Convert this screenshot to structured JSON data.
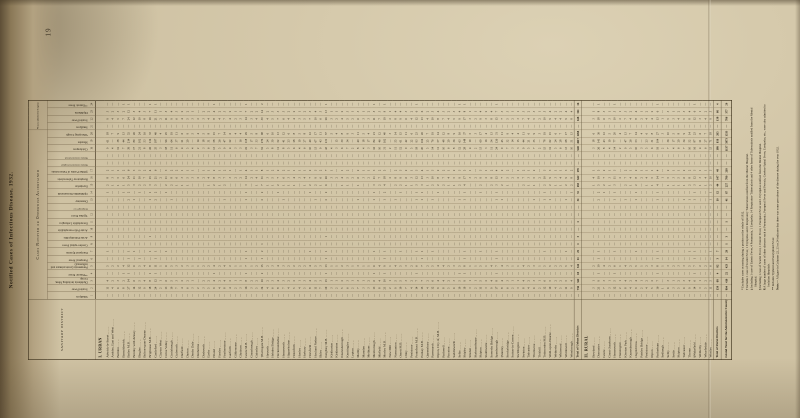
{
  "page": {
    "number": "19",
    "title": "Notified Cases of Infectious Disease, 1932."
  },
  "table": {
    "corner_header": "SANITARY DISTRICT",
    "group_notified": "Cases Notified or Otherwise Ascertained",
    "group_admitted": "¶Cases admitted to Hospital.",
    "columns": [
      {
        "num": "1",
        "label": "Smallpox",
        "thin": false
      },
      {
        "num": "2",
        "label": "Scarlet Fever",
        "thin": false
      },
      {
        "num": "3",
        "label": "Diphtheria including Mem. Croup",
        "thin": false
      },
      {
        "num": "4",
        "label": "**Enteric Fever",
        "thin": false
      },
      {
        "num": "5",
        "label": "Pneumonia (acute primary and influenzal)",
        "thin": false
      },
      {
        "num": "6",
        "label": "Puerperal Fever",
        "thin": false
      },
      {
        "num": "7",
        "label": "Puerperal Pyrexia",
        "thin": false
      },
      {
        "num": "8",
        "label": "Cerebro-spinal Fever",
        "thin": false
      },
      {
        "num": "9",
        "label": "Acute Poliomyelitis",
        "thin": false
      },
      {
        "num": "10",
        "label": "Acute Polio-encephalitis",
        "thin": false
      },
      {
        "num": "11",
        "label": "Encephalitis Lethargica",
        "thin": false
      },
      {
        "num": "12",
        "label": "Typhus Fever",
        "thin": false
      },
      {
        "num": "",
        "label": "Relapsing Fever",
        "thin": true
      },
      {
        "num": "13",
        "label": "Dysentery",
        "thin": false
      },
      {
        "num": "14",
        "label": "Ophthalmia Neonatorum",
        "thin": false
      },
      {
        "num": "15",
        "label": "Erysipelas",
        "thin": false
      },
      {
        "num": "16",
        "label": "Respiratory Tuberculosis",
        "thin": false
      },
      {
        "num": "17",
        "label": "§Other Forms of Tuberculosis",
        "thin": false
      },
      {
        "num": "",
        "label": "Malaria contracted in England",
        "thin": true
      },
      {
        "num": "",
        "label": "Malaria contracted abroad",
        "thin": true
      },
      {
        "num": "18",
        "label": "Chickenpox",
        "thin": false
      },
      {
        "num": "19",
        "label": "Measles",
        "thin": false
      },
      {
        "num": "20",
        "label": "Whooping Cough",
        "thin": false
      },
      {
        "num": "21",
        "label": "Smallpox",
        "thin": false
      },
      {
        "num": "22",
        "label": "Scarlet Fever",
        "thin": false
      },
      {
        "num": "23",
        "label": "Diphtheria",
        "thin": false
      },
      {
        "num": "24",
        "label": "**Enteric Fever",
        "thin": false
      }
    ],
    "sections": [
      {
        "header": "I. URBAN",
        "rows": [
          {
            "name": "Adwick-le-Street",
            "v": "— 11 4 — 5 — 1 — — — — — — — 1 2 8 2 — — 9 61 18 — 9 3 —"
          },
          {
            "name": "Ardsley, East and West",
            "v": "— 4 2 — 2 — — — — — — — — — — 1 3 1 — — 4 — 7 — 4 2 —"
          },
          {
            "name": "Baildon",
            "v": "— 6 3 — 2 — — — — — — — — — — 1 5 1 — — 12 38 9 — 5 3 —"
          },
          {
            "name": "Barnoldswick",
            "v": "— 8 2 1 4 — — — — — — — — — 1 1 6 2 — — 7 44 13 — 7 2 1"
          },
          {
            "name": "Batley M.B.",
            "v": "— 27 14 1 12 1 1 — — — — — — 2 2 5 24 6 — — 39 214 52 — 24 12 1"
          },
          {
            "name": "Bentley with Arksey",
            "v": "— 14 6 — 6 — 1 — — — — — — 1 — 3 11 3 — — 17 89 26 — 12 5 —"
          },
          {
            "name": "Bingley",
            "v": "— 12 5 — 5 1 — — — — — — — — 1 2 10 3 — — 21 102 24 — 10 4 —"
          },
          {
            "name": "Bolton-upon-Dearne",
            "v": "— 9 4 — 4 — — — — — — — — — — 2 7 2 — — 8 53 16 — 8 3 —"
          },
          {
            "name": "Brighouse M.B.",
            "v": "— 18 8 1 8 — 1 — 1 — — — — 1 1 3 15 4 — — 26 134 33 — 16 7 1"
          },
          {
            "name": "Castleford",
            "v": "— 24 12 1 11 1 1 — — — — — — 2 2 5 21 6 — — 35 187 46 — 21 11 1"
          },
          {
            "name": "Clayton West",
            "v": "— 2 1 — 1 — — — — — — — — — — — 2 — — — 3 — 4 — 2 1 —"
          },
          {
            "name": "Colne Valley",
            "v": "— 13 6 — 6 — 1 — — — — — — — 1 2 11 3 — — 18 96 25 — 11 5 —"
          },
          {
            "name": "Conisbrough",
            "v": "— 10 5 — 5 — — — — — — — — 1 — 2 8 2 — — 11 64 19 — 9 4 —"
          },
          {
            "name": "Cudworth",
            "v": "— 7 3 — 3 — — — — — — — — — — 1 6 2 — — 6 37 11 — 6 3 —"
          },
          {
            "name": "Darfield",
            "v": "— 4 2 — 2 — — — — — — — — — — 1 3 1 — — 4 21 6 — 4 2 —"
          },
          {
            "name": "Darton",
            "v": "— 6 2 — 3 — — — — — — — — — — 1 5 1 — — 5 29 9 — 5 2 —"
          },
          {
            "name": "Denby Dale",
            "v": "— 3 1 — 1 — — — — — — — — — — — 3 1 — — 4 — 5 — 3 1 —"
          },
          {
            "name": "Denholme",
            "v": "— 2 — — 1 — — — — — — — — — — — 2 — — — 2 14 4 — 2 — —"
          },
          {
            "name": "Dodworth",
            "v": "— 3 2 — 2 — — — — — — — — — — — 2 1 — — 3 18 5 — 3 2 —"
          },
          {
            "name": "Earby",
            "v": "— 5 2 — 2 — — — — — — — — — — 1 4 1 — — 6 31 8 — 4 2 —"
          },
          {
            "name": "Elland",
            "v": "— 9 4 1 4 — — — — — — — — — — 2 8 2 — — 13 58 15 — 8 4 1"
          },
          {
            "name": "Farsley",
            "v": "— 4 2 — 2 — — — — — — — — — — 1 3 1 — — 5 26 7 — 4 2 —"
          },
          {
            "name": "Featherstone",
            "v": "— 8 4 — 4 — — — — — — — — 1 — 2 7 2 — — 9 47 14 — 7 3 —"
          },
          {
            "name": "Garforth",
            "v": "— 4 2 — 2 — — — — — — — — — — — 3 1 — — 4 22 6 — 4 2 —"
          },
          {
            "name": "Gildersome",
            "v": "— 2 1 — 1 — — — — — — — — — — — 2 — — — 3 — 4 — 2 1 —"
          },
          {
            "name": "Glusburn",
            "v": "— 3 1 — 1 — — — — — — — — — — — 2 1 — — 3 16 4 — 3 1 —"
          },
          {
            "name": "Goole M.B.",
            "v": "— 16 8 1 7 1 1 — — — — — — 1 1 3 14 4 — — 22 118 29 — 14 7 1"
          },
          {
            "name": "Greasbrough",
            "v": "— 3 2 — 1 — — — — — — — — — — — 2 1 — — 3 17 5 — 3 2 —"
          },
          {
            "name": "Guiseley",
            "v": "— 5 2 — 2 — — — — — — — — — — 1 4 1 — — 7 33 8 — 4 2 —"
          },
          {
            "name": "†Harrogate M.B.",
            "v": "— 34 16 2 15 1 2 1 — — — — — 2 2 7 31 8 — — 52 276 68 — 30 14 2"
          },
          {
            "name": "Haworth",
            "v": "— 4 2 — 2 — — — — — — — — — — 1 3 1 — — 5 24 6 — 4 2 —"
          },
          {
            "name": "Hebden Bridge",
            "v": "— 6 3 — 3 — — — — — — — — — — 1 5 2 — — 8 39 10 — 5 3 —"
          },
          {
            "name": "Heckmondwike",
            "v": "— 8 4 — 4 — — — — — — — — — 1 2 7 2 — — 11 52 13 — 7 3 —"
          },
          {
            "name": "Hemsworth",
            "v": "— 7 3 — 3 — — — — — — — — 1 — 1 6 2 — — 8 41 12 — 6 3 —"
          },
          {
            "name": "Hipperholme",
            "v": "— 4 2 — 2 — — — — — — — — — — 1 3 1 — — 5 23 6 — 4 2 —"
          },
          {
            "name": "Holmfirth",
            "v": "— 5 2 — 2 — — — — — — — — — — 1 4 1 — — 6 28 8 — 4 2 —"
          },
          {
            "name": "Honley",
            "v": "— 4 1 — 2 — — — — — — — — — — — 3 1 — — 4 19 5 — 3 1 —"
          },
          {
            "name": "Horbury",
            "v": "— 5 3 — 2 — — — — — — — — — — 1 4 1 — — 6 27 8 — 5 2 —"
          },
          {
            "name": "Horsforth",
            "v": "— 8 4 — 4 — 1 — — — — — — — 1 2 7 2 — — 10 49 12 — 7 3 —"
          },
          {
            "name": "Hoyland Nether",
            "v": "— 11 5 — 5 — — — — — — — — 1 — 2 9 3 — — 13 67 17 — 10 4 —"
          },
          {
            "name": "Ilkley",
            "v": "— 7 3 — 3 — — — — — — — — — — 1 6 2 — — 9 43 11 — 6 3 —"
          },
          {
            "name": "Keighley M.B.",
            "v": "— 29 15 1 13 1 1 — 1 — — — — 2 2 6 26 7 — — 43 231 57 — 26 13 1"
          },
          {
            "name": "Kirkburton",
            "v": "— 3 1 — 1 — — — — — — — — — — — 3 1 — — 4 — 5 — 3 1 —"
          },
          {
            "name": "Kirkheaton",
            "v": "— 2 1 — 1 — — — — — — — — — — — 2 — — — 3 15 4 — 2 1 —"
          },
          {
            "name": "Knaresborough",
            "v": "— 5 2 — 2 — — — — — — — — — — 1 4 1 — — 6 30 8 — 4 2 —"
          },
          {
            "name": "Knottingley",
            "v": "— 6 3 — 3 — — — — — — — — — — 1 5 2 — — 7 34 9 — 5 3 —"
          },
          {
            "name": "Lepton",
            "v": "— 2 1 — 1 — — — — — — — — — — — 2 — — — 2 — 3 — 2 1 —"
          },
          {
            "name": "Maltby",
            "v": "— 7 3 — 3 — — — — — — — — 1 — 1 6 2 — — 8 40 11 — 6 3 —"
          },
          {
            "name": "Marsden",
            "v": "— 3 1 — 1 — — — — — — — — — — — 3 1 — — 4 18 5 — 3 1 —"
          },
          {
            "name": "Meltham",
            "v": "— 3 2 — 1 — — — — — — — — — — — 2 1 — — 3 17 4 — 3 2 —"
          },
          {
            "name": "Mexborough",
            "v": "— 13 6 1 6 — 1 — — — — — — 1 1 3 11 3 — — 16 84 21 — 11 5 1"
          },
          {
            "name": "Mirfield",
            "v": "— 8 4 — 4 — — — — — — — — — — 2 7 2 — — 10 46 12 — 7 3 —"
          },
          {
            "name": "Morley M.B.",
            "v": "— 21 10 1 9 1 1 — — — — — — 1 2 4 18 5 — — 31 162 40 — 19 9 1"
          },
          {
            "name": "New Mill",
            "v": "— 2 1 — 1 — — — — — — — — — — — 2 — — — 2 — 3 — 2 1 —"
          },
          {
            "name": "Normanton",
            "v": "— 9 5 — 4 — — — — — — — — 1 — 2 8 2 — — 11 55 14 — 8 4 —"
          },
          {
            "name": "Ossett M.B.",
            "v": "— 10 5 — 5 — 1 — — — — — — — 1 2 9 3 — — 12 61 15 — 9 4 —"
          },
          {
            "name": "Otley",
            "v": "— 7 3 — 3 — — — — — — — — — — 1 6 2 — — 9 42 11 — 6 3 —"
          },
          {
            "name": "Penistone",
            "v": "— 4 2 — 2 — — — — — — — — — — 1 3 1 — — 5 22 6 — 4 2 —"
          },
          {
            "name": "Pontefract M.B.",
            "v": "— 14 7 1 6 — 1 — — — — — — 1 1 3 12 3 — — 18 93 23 — 12 6 1"
          },
          {
            "name": "Pudsey M.B.",
            "v": "— 15 7 — 7 1 1 — — — — — — 1 1 3 13 4 — — 20 104 26 — 13 6 —"
          },
          {
            "name": "Queensbury",
            "v": "— 4 2 — 2 — — — — — — — — — — 1 3 1 — — 5 25 7 — 4 2 —"
          },
          {
            "name": "Rawmarsh",
            "v": "— 12 6 — 5 — 1 — — — — — — 1 — 2 10 3 — — 14 76 19 — 10 5 —"
          },
          {
            "name": "Ripon, City of, M.B.",
            "v": "— 9 4 — 4 — — — — — — — — — 1 2 8 2 — — 11 57 14 — 8 4 —"
          },
          {
            "name": "Rothwell",
            "v": "— 8 4 — 4 — — — — — — — — — — 2 7 2 — — 10 48 12 — 7 3 —"
          },
          {
            "name": "Royston",
            "v": "— 5 2 — 2 — — — — — — — — — — 1 4 1 — — 6 29 8 — 4 2 —"
          },
          {
            "name": "Saddleworth",
            "v": "— 6 3 — 3 — — — — — — — — — — 1 5 2 — — 8 36 9 — 5 3 —"
          },
          {
            "name": "Selby",
            "v": "— 10 5 1 5 — — — — — — — — 1 — 2 9 3 — — 12 63 16 — 9 4 1"
          },
          {
            "name": "Shipley",
            "v": "— 19 9 1 8 1 1 — — — — — — 1 1 4 17 5 — — 28 148 37 — 17 8 1"
          },
          {
            "name": "Silsden",
            "v": "— 3 1 — 1 — — — — — — — — — — — 3 1 — — 4 19 5 — 3 1 —"
          },
          {
            "name": "Skelmanthorpe",
            "v": "— 2 1 — 1 — — — — — — — — — — — 2 — — — 2 — 3 — 2 1 —"
          },
          {
            "name": "Skipton",
            "v": "— 11 5 — 5 — 1 — — — — — — — 1 2 9 3 — — 13 69 17 — 9 4 —"
          },
          {
            "name": "Slaithwaite",
            "v": "— 3 2 — 1 — — — — — — — — — — — 2 1 — — 3 16 4 — 3 2 —"
          },
          {
            "name": "Sowerby Bridge",
            "v": "— 9 4 — 4 — — — — — — — — — — 2 8 2 — — 11 54 13 — 8 4 —"
          },
          {
            "name": "Spenborough",
            "v": "— 17 8 1 7 1 1 — — — — — — 1 1 3 15 4 — — 24 126 31 — 15 7 1"
          },
          {
            "name": "‡Stanley",
            "v": "— 8 4 — 4 — — — — — — — — 1 — 2 7 2 — — 9 45 11 — 7 3 —"
          },
          {
            "name": "Stocksbridge",
            "v": "— 6 3 — 3 — — — — — — — — — — 1 5 2 — — 7 32 9 — 5 3 —"
          },
          {
            "name": "Sutton-in-Craven",
            "v": "— 2 1 — 1 — — — — — — — — — — — 2 — — — 3 14 4 — 2 1 —"
          },
          {
            "name": "Swillington",
            "v": "— 3 1 — 1 — — — — — — — — — — — 2 1 — — 3 15 4 — 3 1 —"
          },
          {
            "name": "Swinton",
            "v": "— 8 4 — 4 — — — — — — — — — — 2 7 2 — — 9 44 11 — 7 3 —"
          },
          {
            "name": "Tadcaster",
            "v": "— 4 2 — 2 — — — — — — — — — — 1 3 1 — — 5 21 6 — 4 2 —"
          },
          {
            "name": "Thurnscoe",
            "v": "— 6 3 — 3 — — — — — — — — 1 — 1 5 2 — — 7 35 9 — 5 3 —"
          },
          {
            "name": "Tickhill",
            "v": "— 2 1 — 1 — — — — — — — — — — — 2 — — — 2 — 3 — 2 1 —"
          },
          {
            "name": "Todmorden M.B.",
            "v": "— 12 6 — 5 — 1 — — — — — — 1 1 2 10 3 — — 15 78 19 — 10 5 —"
          },
          {
            "name": "Wath-upon-Dearne",
            "v": "— 10 5 — 5 — — — — — — — — 1 — 2 9 3 — — 12 62 15 — 9 4 —"
          },
          {
            "name": "Wetherby",
            "v": "— 4 2 — 2 — — — — — — — — — — 1 3 1 — — 5 24 6 — 4 2 —"
          },
          {
            "name": "Whitwood",
            "v": "— 5 2 — 2 — — — — — — — — — — 1 4 1 — — 6 28 7 — 4 2 —"
          },
          {
            "name": "Wombwell",
            "v": "— 11 5 — 5 — 1 — — — — — — 1 — 2 9 3 — — 13 68 17 — 9 4 —"
          },
          {
            "name": "Worsbrough",
            "v": "— 9 4 — 4 — — — — — — — — — 1 2 8 2 — — 10 51 13 — 8 4 —"
          }
        ]
      },
      {
        "total": {
          "name": "Total of Urban Districts",
          "v": "— 736 342 18 341 11 22 1 3 — 1 — — 31 55 183 642 178 — — 948 4917 1268 — 648 311 16"
        }
      },
      {
        "header": "II. RURAL",
        "rows": [
          {
            "name": "Bowland",
            "v": "— 3 1 — 2 — — — — — — — — — — 1 4 1 — — 3 18 6 — 3 1 —"
          },
          {
            "name": "Doncaster",
            "v": "— 21 9 1 10 1 1 — — — — — — 2 2 5 19 5 — — 26 141 36 — 18 8 1"
          },
          {
            "name": "Goole",
            "v": "— 7 3 — 4 — — — — — — — — — 1 2 7 2 — — 8 43 12 — 6 3 —"
          },
          {
            "name": "Great Ouseburn",
            "v": "— 3 1 — 2 — — — — — — — — — — 1 3 1 — — 4 19 5 — 3 1 —"
          },
          {
            "name": "Hemsworth",
            "v": "— 12 5 1 6 — 1 — — — — — — 1 1 3 11 3 — — 14 77 20 — 10 5 1"
          },
          {
            "name": "Hunsingore",
            "v": "— 2 1 — 1 — — — — — — — — — — — 2 — — — 2 — 4 — 2 1 —"
          },
          {
            "name": "Kiveton Park",
            "v": "— 8 4 — 4 — — — — — — — — 1 — 2 7 2 — — 9 47 13 — 7 3 —"
          },
          {
            "name": "Knaresborough",
            "v": "— 4 2 — 2 — — — — — — — — — — 1 4 1 — — 5 26 7 — 4 2 —"
          },
          {
            "name": "Osgoldcross",
            "v": "— 9 4 — 5 — 1 — — — — — — 1 1 2 8 2 — — 10 53 14 — 8 4 —"
          },
          {
            "name": "Pateley Bridge",
            "v": "— 2 1 — 1 — — — — — — — — — — — 2 1 — — 3 — 4 — 2 1 —"
          },
          {
            "name": "Penistone",
            "v": "— 4 2 — 2 — — — — — — — — — — 1 4 1 — — 5 23 6 — 4 2 —"
          },
          {
            "name": "Ripon",
            "v": "— 5 2 — 3 — — — — — — — — — — 1 5 1 — — 6 31 8 — 4 2 —"
          },
          {
            "name": "Rotherham",
            "v": "— 16 7 1 8 1 1 — — — — — — 1 1 4 14 4 — — 19 104 27 — 13 6 1"
          },
          {
            "name": "Sedbergh",
            "v": "— 1 — — 1 — — — — — — — — — — — 1 — — — 2 — 3 — 1 — —"
          },
          {
            "name": "Selby",
            "v": "— 6 3 — 3 — — — — — — — — — — 1 5 2 — — 7 36 10 — 5 3 —"
          },
          {
            "name": "Settle",
            "v": "— 3 1 — 2 — — — — — — — — — — 1 3 1 — — 4 17 5 — 3 1 —"
          },
          {
            "name": "Skipton",
            "v": "— 5 2 — 3 — — — — — — — — — — 1 5 1 — — 6 29 8 — 4 2 —"
          },
          {
            "name": "Tadcaster",
            "v": "— 6 3 — 3 — — — — — — — — 1 — 1 6 2 — — 7 34 9 — 5 3 —"
          },
          {
            "name": "Thorne",
            "v": "— 9 4 — 5 — 1 — — — — — — 1 — 2 8 2 — — 10 52 14 — 8 4 —"
          },
          {
            "name": "§Wakefield",
            "v": "— 14 6 1 7 1 1 — — — — — — 1 1 3 12 3 — — 16 87 23 — 12 6 1"
          },
          {
            "name": "Wetherby",
            "v": "— 3 1 — 2 — — — — — — — — — — 1 3 1 — — 4 21 6 — 3 1 —"
          },
          {
            "name": "Wharfedale",
            "v": "— 5 2 — 2 — — — — — — — — — — 1 4 1 — — 6 27 7 — 4 2 —"
          },
          {
            "name": "Wortley",
            "v": "— 11 5 — 6 — 1 — — — — — — 1 1 2 10 3 — — 13 71 18 — 9 5 —"
          }
        ]
      },
      {
        "total": {
          "name": "Total of Rural Districts",
          "v": "— 158 68 4 82 3 7 — — — — — — 10 12 44 147 40 — — 189 956 265 — 138 66 4"
        }
      },
      {
        "total": {
          "name": "Grand Total for the Administrative County",
          "v": "— 894 410 22 423 14 29 1 3 — 1 — — 41 67 227 789 218 — — 1137 5873 1533 — 786 377 20",
          "grand": true
        }
      }
    ]
  },
  "footnotes": [
    {
      "m": "*",
      "t": "Excludes cases occurring during a portion or the whole of 1932."
    },
    {
      "m": "†",
      "t": "Includes 1 case of Scarlet Fever, 1 Erysipelas and 6 Respiratory Tuberculosis notified from the Mental Hospital."
    },
    {
      "m": "‡",
      "t": "Including 1 case of Enteric Fever, 4 Pneumonia, 1 Erysipelas, 14 Respiratory Tuberculosis and 4 other forms of Tuberculosis notified from the Mental Hospital."
    },
    {
      "m": "§",
      "t": "Including 1 case of Scarlet Fever, 1 Enteric Fever, 1 Puerperal Fever and 1 Erysipelas notified from the Mental Hospital."
    },
    {
      "m": "¶",
      "t": "A large number of cases of other diseases such as Pneumonia, Puerperal Fever and Pyrexia, Cerebro-Spinal Fever, Erysipelas, etc., were also admitted to Isolation Hospitals."
    },
    {
      "m": "**",
      "t": "Includes Typhoid and Paratyphoid Fever."
    },
    {
      "m": "Note:—",
      "t": "A figure in Columns 22, 23 or 24 indicates that there was some prevalence of the disease during the year 1932."
    }
  ]
}
